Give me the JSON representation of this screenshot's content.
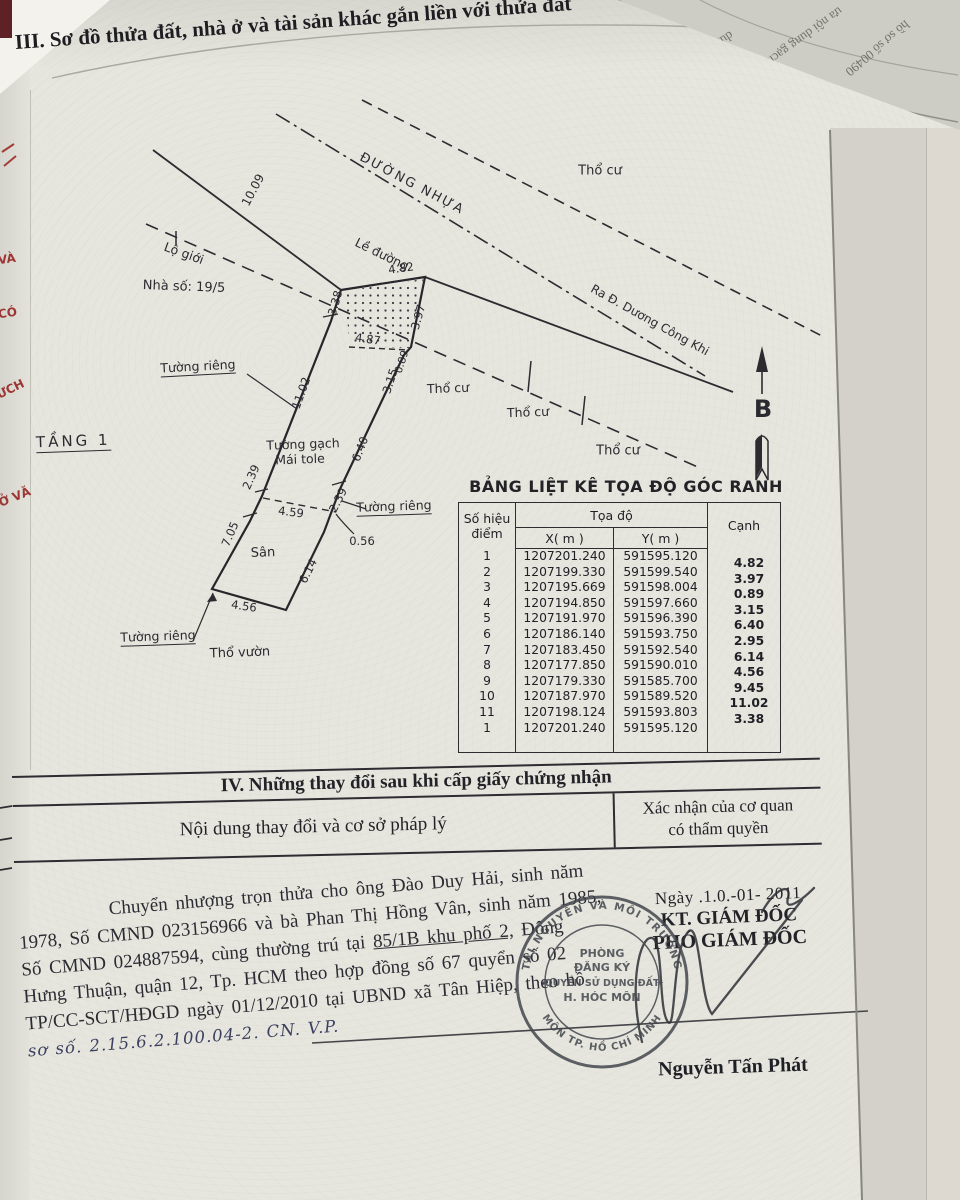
{
  "doc": {
    "section3_title": "III. Sơ đồ thửa đất, nhà ở và tài sản khác gắn liền với thửa đất",
    "floor_label": "TẦNG 1"
  },
  "fold": {
    "fragment1": "dung thay đổ",
    "fragment2": "ưa nội dung gạch",
    "fragment3": "hồ sơ số 00490",
    "edge_red_1": "VÀ",
    "edge_red_2": "CÓ",
    "edge_red_3": "ƯCH",
    "edge_red_4": "Ở VĂ"
  },
  "diagram": {
    "road_label": "ĐƯỜNG NHỰA",
    "road_exit_label": "Ra Đ. Dương Công Khi",
    "curb_label": "Lề đường",
    "boundary_label": "Lộ giới",
    "house_number": "Nhà số: 19/5",
    "residential_label": "Thổ cư",
    "garden_label": "Thổ vườn",
    "yard_label": "Sân",
    "private_wall_label": "Tường riêng",
    "brick_wall_label": "Tường gạch",
    "roof_label": "Mái tole",
    "north_label": "B",
    "dims": {
      "road_width": "10.09",
      "top_width": "4.82",
      "hatch_bottom": "4.87",
      "left1": "3.38",
      "left2": "11.02",
      "left3": "2.39",
      "left4": "7.05",
      "right1": "3.97",
      "right2": "0.89",
      "right3": "3.15",
      "right4": "6.40",
      "right5": "2.39",
      "right6": "0.56",
      "right7": "6.14",
      "bottom": "4.56",
      "partition": "4.59"
    }
  },
  "table": {
    "title": "BẢNG LIỆT KÊ TỌA ĐỘ GÓC RANH",
    "col_point_1": "Số hiệu",
    "col_point_2": "điểm",
    "col_coord": "Tọa độ",
    "col_x": "X( m )",
    "col_y": "Y( m )",
    "col_edge": "Cạnh",
    "rows": [
      {
        "n": "1",
        "x": "1207201.240",
        "y": "591595.120"
      },
      {
        "n": "2",
        "x": "1207199.330",
        "y": "591599.540"
      },
      {
        "n": "3",
        "x": "1207195.669",
        "y": "591598.004"
      },
      {
        "n": "4",
        "x": "1207194.850",
        "y": "591597.660"
      },
      {
        "n": "5",
        "x": "1207191.970",
        "y": "591596.390"
      },
      {
        "n": "6",
        "x": "1207186.140",
        "y": "591593.750"
      },
      {
        "n": "7",
        "x": "1207183.450",
        "y": "591592.540"
      },
      {
        "n": "8",
        "x": "1207177.850",
        "y": "591590.010"
      },
      {
        "n": "9",
        "x": "1207179.330",
        "y": "591585.700"
      },
      {
        "n": "10",
        "x": "1207187.970",
        "y": "591589.520"
      },
      {
        "n": "11",
        "x": "1207198.124",
        "y": "591593.803"
      },
      {
        "n": "1",
        "x": "1207201.240",
        "y": "591595.120"
      }
    ],
    "edges": [
      "4.82",
      "3.97",
      "0.89",
      "3.15",
      "6.40",
      "2.95",
      "6.14",
      "4.56",
      "9.45",
      "11.02",
      "3.38"
    ]
  },
  "section4": {
    "title": "IV. Những thay đổi sau khi cấp giấy chứng nhận",
    "left_header": "Nội dung thay đổi và cơ sở pháp lý",
    "right_header_1": "Xác nhận của cơ quan",
    "right_header_2": "có thẩm quyền"
  },
  "amendment": {
    "date_line": "Ngày .1.0.-01-  2011",
    "kt": "KT. GIÁM ĐỐC",
    "deputy": "PHÓ GIÁM ĐỐC",
    "signer": "Nguyễn Tấn Phát",
    "line1": "Chuyển nhượng trọn thửa cho ông Đào Duy Hải, sinh năm",
    "line2": "1978, Số CMND 023156966 và bà Phan Thị Hồng Vân, sinh năm 1985,",
    "line3a": "Số CMND 024887594, cùng thường trú tại ",
    "line3b": "85/1B khu phố 2,",
    "line3c": " Đông",
    "line4": "Hưng Thuận, quận 12, Tp. HCM theo hợp đồng số 67 quyển số 02",
    "line5": "TP/CC-SCT/HĐGD ngày 01/12/2010 tại UBND xã Tân Hiệp, theo hồ",
    "line6": "sơ số. 2.15.6.2.100.04-2. CN. V.P."
  },
  "stamp": {
    "ring_top": "TÀI NGUYÊN VÀ MÔI TRƯỜNG",
    "ring_bottom": "MÔN TP. HỒ CHÍ MINH",
    "center1": "PHÒNG",
    "center2": "ĐĂNG KÝ",
    "center3": "QUYỀN SỬ DỤNG ĐẤT",
    "center4": "H. HÓC MÔN"
  }
}
